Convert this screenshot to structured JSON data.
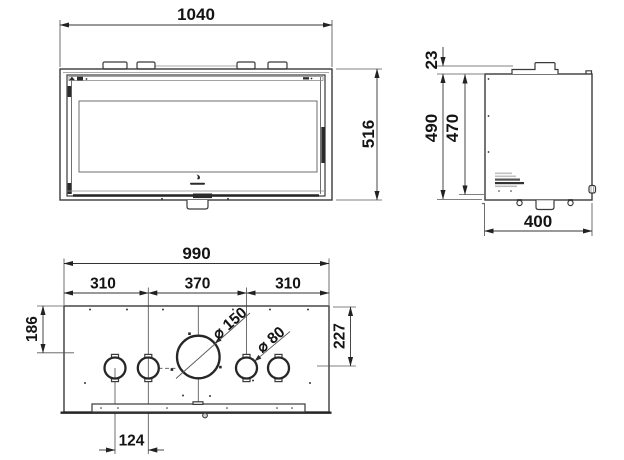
{
  "drawing_labels": {
    "front": {
      "width": "1040",
      "height": "516"
    },
    "side": {
      "flue_step": "23",
      "height_total": "490",
      "height_inner": "470",
      "depth": "400"
    },
    "plan": {
      "width": "990",
      "segment_left": "310",
      "segment_center": "370",
      "segment_right": "310",
      "depth_to_flue_center": "186",
      "depth_to_duct_center": "227",
      "duct_spacing": "124",
      "flue_diameter": "⌀ 150",
      "duct_diameter": "⌀ 80"
    }
  }
}
